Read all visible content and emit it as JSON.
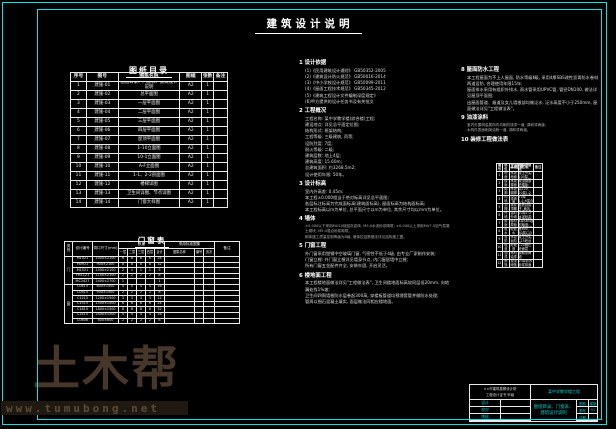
{
  "sheet": {
    "title": "建筑设计说明"
  },
  "catalog": {
    "title": "图纸目录",
    "h": {
      "no": "序号",
      "code": "图号",
      "name": "图纸名称",
      "size": "图幅",
      "count": "张数",
      "note": "备注"
    },
    "rows": [
      {
        "no": "1",
        "code": "建施-01",
        "name": "图纸目录、门窗表、建筑设计说明",
        "size": "A2",
        "count": "1",
        "note": ""
      },
      {
        "no": "2",
        "code": "建施-02",
        "name": "总平面图",
        "size": "A2",
        "count": "1",
        "note": ""
      },
      {
        "no": "3",
        "code": "建施-03",
        "name": "一层平面图",
        "size": "A2",
        "count": "1",
        "note": ""
      },
      {
        "no": "4",
        "code": "建施-04",
        "name": "二层平面图",
        "size": "A2",
        "count": "1",
        "note": ""
      },
      {
        "no": "5",
        "code": "建施-05",
        "name": "三层平面图",
        "size": "A2",
        "count": "1",
        "note": ""
      },
      {
        "no": "6",
        "code": "建施-06",
        "name": "四层平面图",
        "size": "A2",
        "count": "1",
        "note": ""
      },
      {
        "no": "7",
        "code": "建施-07",
        "name": "屋顶平面图",
        "size": "A2",
        "count": "1",
        "note": ""
      },
      {
        "no": "8",
        "code": "建施-08",
        "name": "1-10立面图",
        "size": "A2",
        "count": "1",
        "note": ""
      },
      {
        "no": "9",
        "code": "建施-09",
        "name": "10-1立面图",
        "size": "A2",
        "count": "1",
        "note": ""
      },
      {
        "no": "10",
        "code": "建施-10",
        "name": "A-F立面图",
        "size": "A2",
        "count": "1",
        "note": ""
      },
      {
        "no": "11",
        "code": "建施-11",
        "name": "1-1、2-2剖面图",
        "size": "A2",
        "count": "1",
        "note": ""
      },
      {
        "no": "12",
        "code": "建施-12",
        "name": "楼梯详图",
        "size": "A2",
        "count": "1",
        "note": ""
      },
      {
        "no": "13",
        "code": "建施-13",
        "name": "卫生间详图、节点详图",
        "size": "A2",
        "count": "1",
        "note": ""
      },
      {
        "no": "14",
        "code": "建施-14",
        "name": "门窗大样图",
        "size": "A2",
        "count": "1",
        "note": ""
      }
    ]
  },
  "dw": {
    "title": "门窗表",
    "h": {
      "cat": "类别",
      "id": "设计编号",
      "open": "洞口尺寸(mm)",
      "qty": "数量",
      "f1": "一层",
      "f2": "二层",
      "f3": "三层",
      "f4": "四层",
      "sum": "合计",
      "atlas": "采用标准图集",
      "aname": "图集名称",
      "ano": "编号",
      "pg": "页次",
      "note": "备注",
      "door": "门",
      "win": "窗"
    },
    "doors": [
      {
        "id": "M1021",
        "open": "1000×2100",
        "f1": "6",
        "f2": "6",
        "f3": "6",
        "f4": "6",
        "sum": "24",
        "aname": "",
        "ano": "",
        "pg": "",
        "note": ""
      },
      {
        "id": "M0921",
        "open": "900×2100",
        "f1": "8",
        "f2": "8",
        "f3": "8",
        "f4": "8",
        "sum": "32",
        "aname": "",
        "ano": "",
        "pg": "",
        "note": ""
      },
      {
        "id": "M1521",
        "open": "1500×2100",
        "f1": "2",
        "f2": "1",
        "f3": "1",
        "f4": "1",
        "sum": "5",
        "aname": "",
        "ano": "",
        "pg": "",
        "note": ""
      },
      {
        "id": "FM1121",
        "open": "1100×2100",
        "f1": "2",
        "f2": "2",
        "f3": "2",
        "f4": "2",
        "sum": "8",
        "aname": "",
        "ano": "",
        "pg": "",
        "note": ""
      },
      {
        "id": "MC2427",
        "open": "2400×2700",
        "f1": "1",
        "f2": "",
        "f3": "",
        "f4": "",
        "sum": "1",
        "aname": "",
        "ano": "",
        "pg": "",
        "note": ""
      }
    ],
    "windows": [
      {
        "id": "C0615",
        "open": "600×1500",
        "f1": "4",
        "f2": "4",
        "f3": "4",
        "f4": "4",
        "sum": "16",
        "aname": "",
        "ano": "",
        "pg": "",
        "note": ""
      },
      {
        "id": "C0915",
        "open": "900×1500",
        "f1": "2",
        "f2": "2",
        "f3": "2",
        "f4": "2",
        "sum": "8",
        "aname": "",
        "ano": "",
        "pg": "",
        "note": ""
      },
      {
        "id": "C1215",
        "open": "1200×1500",
        "f1": "3",
        "f2": "3",
        "f3": "3",
        "f4": "3",
        "sum": "12",
        "aname": "",
        "ano": "",
        "pg": "",
        "note": ""
      },
      {
        "id": "C1515",
        "open": "1500×1500",
        "f1": "6",
        "f2": "6",
        "f3": "6",
        "f4": "6",
        "sum": "24",
        "aname": "",
        "ano": "",
        "pg": "",
        "note": ""
      },
      {
        "id": "C1815",
        "open": "1800×1500",
        "f1": "8",
        "f2": "8",
        "f3": "8",
        "f4": "8",
        "sum": "32",
        "aname": "",
        "ano": "",
        "pg": "",
        "note": ""
      },
      {
        "id": "C2415",
        "open": "2400×1500",
        "f1": "4",
        "f2": "4",
        "f3": "4",
        "f4": "4",
        "sum": "16",
        "aname": "",
        "ano": "",
        "pg": "",
        "note": ""
      },
      {
        "id": "C0606",
        "open": "600×600",
        "f1": "2",
        "f2": "2",
        "f3": "2",
        "f4": "2",
        "sum": "8",
        "aname": "",
        "ano": "",
        "pg": "",
        "note": ""
      }
    ]
  },
  "notes_mid": {
    "lines": [
      {
        "t": "1 设计依据",
        "c": "h"
      },
      {
        "t": "(1)《民用建筑设计通则》 GB50352-2005",
        "c": "t"
      },
      {
        "t": "(2)《建筑设计防火规范》 GB50016-2014",
        "c": "t"
      },
      {
        "t": "(3)《中小学校设计规范》 GB50099-2011",
        "c": "t"
      },
      {
        "t": "(4)《屋面工程技术规范》 GB50345-2012",
        "c": "t"
      },
      {
        "t": "(5)《建筑工程设计文件编制深度规定》",
        "c": "t"
      },
      {
        "t": "(6)甲方提供的设计任务书及有关批文",
        "c": "t"
      },
      {
        "t": "2 工程概况",
        "c": "h"
      },
      {
        "t": "工程名称: 某中学教学楼(综合楼)工程;",
        "c": "t"
      },
      {
        "t": "建设地点: 详见总平面定位图;",
        "c": "t"
      },
      {
        "t": "结构形式: 框架结构;",
        "c": "t"
      },
      {
        "t": "工程等级: 三级建筑, 丙等;",
        "c": "t"
      },
      {
        "t": "设防烈度: 7度;",
        "c": "t"
      },
      {
        "t": "耐火等级: 二级;",
        "c": "t"
      },
      {
        "t": "建筑层数: 地上4层;",
        "c": "t"
      },
      {
        "t": "建筑高度: 15.60m;",
        "c": "t"
      },
      {
        "t": "总建筑面积: 约3268.5m2;",
        "c": "t"
      },
      {
        "t": "设计使用年限: 50年。",
        "c": "t"
      },
      {
        "t": "3 设计标高",
        "c": "h"
      },
      {
        "t": "室内外高差: 0.45m;",
        "c": "t"
      },
      {
        "t": "本工程±0.000相当于绝对标高详见总平面图;",
        "c": "t"
      },
      {
        "t": "各层标注标高为完成面标高(建筑面标高), 屋面标高为结构面标高;",
        "c": "t"
      },
      {
        "t": "本工程标高以m为单位, 总平面尺寸以m为单位, 其余尺寸均以mm为单位。",
        "c": "t"
      },
      {
        "t": "4 墙体",
        "c": "h"
      },
      {
        "t": "±0.000以下采用MU10烧结页岩砖, M5.0水泥砂浆砌筑;  ±0.000以上采用MU7.5加气混凝土砌块, M5.0混合砂浆砌筑。",
        "c": "d"
      },
      {
        "t": "砌体施工质量控制等级为B级, 墙体拉结筋做法详见结构施工图。",
        "c": "d"
      },
      {
        "t": "5 门窗工程",
        "c": "h"
      },
      {
        "t": "外门窗采用塑钢中空玻璃门窗, 气密性不低于4级, 由专业厂家制作安装;",
        "c": "t"
      },
      {
        "t": "门窗立樘: 外门窗立樘详见墙身节点, 内门窗居墙中立樘;",
        "c": "t"
      },
      {
        "t": "所有门窗五金配件齐全, 安装牢固, 开启灵活。",
        "c": "t"
      },
      {
        "t": "6 楼地面工程",
        "c": "h"
      },
      {
        "t": "本工程楼地面做法详见\"工程做法表\", 卫生间楼地面标高较同层低20mm, 向地漏处找1%坡;",
        "c": "t"
      },
      {
        "t": "卫生间四周墙根防水层卷起300高, 穿楼板管道均预埋套管并做防水处理;",
        "c": "t"
      },
      {
        "t": "管周以细石混凝土填实, 面层做法同相应楼地面。",
        "c": "t"
      }
    ]
  },
  "notes_right": {
    "lines": [
      {
        "t": "8 屋面防水工程",
        "c": "h"
      },
      {
        "t": "本工程屋面为不上人屋面, 防水等级Ⅱ级, 采用4厚SBS改性沥青防水卷材两道设防, 合理使用年限15年;",
        "c": "t"
      },
      {
        "t": "屋面排水采用有组织外排水, 雨水管采用UPVC管, 管径DN100, 做法详见屋顶平面图;",
        "c": "t"
      },
      {
        "t": "出屋面管道、烟道及女儿墙根部均做泛水, 泛水高度不小于250mm, 屋面做法详见\"工程做法表\"。",
        "c": "t"
      },
      {
        "t": "9 油漆涂料",
        "c": "h"
      },
      {
        "t": "室内外露明金属构件均刷防锈漆一道, 调和漆两道;",
        "c": "d"
      },
      {
        "t": "木构件表面刷润油粉一道, 调和漆两道。",
        "c": "d"
      },
      {
        "t": "10 装修工程做法表",
        "c": "h"
      }
    ]
  },
  "finish": {
    "title": "工程做法",
    "h": {
      "c1": "编号",
      "c2": "部位",
      "c3": "名称",
      "c4": "用料及做法",
      "c5": "备注"
    },
    "rows": [
      {
        "c1": "1",
        "c2": "地面",
        "c3": "水泥地面",
        "c4": "素土夯实; 100厚C10砼垫层; 20厚1:2水泥砂浆压光",
        "c5": ""
      },
      {
        "c1": "2",
        "c2": "楼面",
        "c3": "水泥楼面",
        "c4": "现浇钢筋砼楼板; 20厚1:2水泥砂浆面层",
        "c5": ""
      },
      {
        "c1": "3",
        "c2": "踢脚",
        "c3": "水泥踢脚",
        "c4": "高120, 20厚1:2水泥砂浆",
        "c5": ""
      },
      {
        "c1": "4",
        "c2": "内墙",
        "c3": "乳胶漆墙面",
        "c4": "15厚1:1:6混合砂浆; 刮腻子, 刷乳胶漆两道",
        "c5": ""
      },
      {
        "c1": "5",
        "c2": "顶棚",
        "c3": "抹灰顶棚",
        "c4": "板底刮腻子, 刷乳胶漆两道",
        "c5": ""
      },
      {
        "c1": "6",
        "c2": "外墙",
        "c3": "涂料外墙",
        "c4": "20厚1:3水泥砂浆; 外墙涂料",
        "c5": ""
      },
      {
        "c1": "7",
        "c2": "屋面",
        "c3": "卷材屋面",
        "c4": "4厚SBS卷材两道; 20厚砂浆保护层",
        "c5": ""
      },
      {
        "c1": "8",
        "c2": "散水",
        "c3": "砼散水",
        "c4": "宽600, 60厚C15砼随打随抹",
        "c5": ""
      },
      {
        "c1": "9",
        "c2": "台阶",
        "c3": "水泥台阶",
        "c4": "素土夯实, C15砼台阶",
        "c5": ""
      },
      {
        "c1": "10",
        "c2": "坡道",
        "c3": "砼坡道",
        "c4": "C20细石砼面层",
        "c5": ""
      },
      {
        "c1": "11",
        "c2": "油漆",
        "c3": "木材油漆",
        "c4": "调和漆两道",
        "c5": ""
      },
      {
        "c1": "12",
        "c2": "雨篷",
        "c3": "现浇雨篷",
        "c4": "20厚防水砂浆抹面",
        "c5": ""
      }
    ]
  },
  "titleblock": {
    "institute_line1": "××市建筑勘察设计院",
    "institute_line2": "工程设计证书 甲级",
    "project": "某中学教学楼工程",
    "sign_rows": [
      {
        "label": "设计",
        "value": ""
      },
      {
        "label": "校对",
        "value": ""
      },
      {
        "label": "审核",
        "value": ""
      }
    ],
    "sheet_title": "图纸目录、门窗表、建筑设计说明",
    "info": [
      {
        "label": "图别",
        "value": "建施"
      },
      {
        "label": "图号",
        "value": "01"
      },
      {
        "label": "日期",
        "value": ""
      }
    ]
  },
  "watermark": {
    "brand": "土木帮",
    "url": "www.tumubong.net"
  }
}
